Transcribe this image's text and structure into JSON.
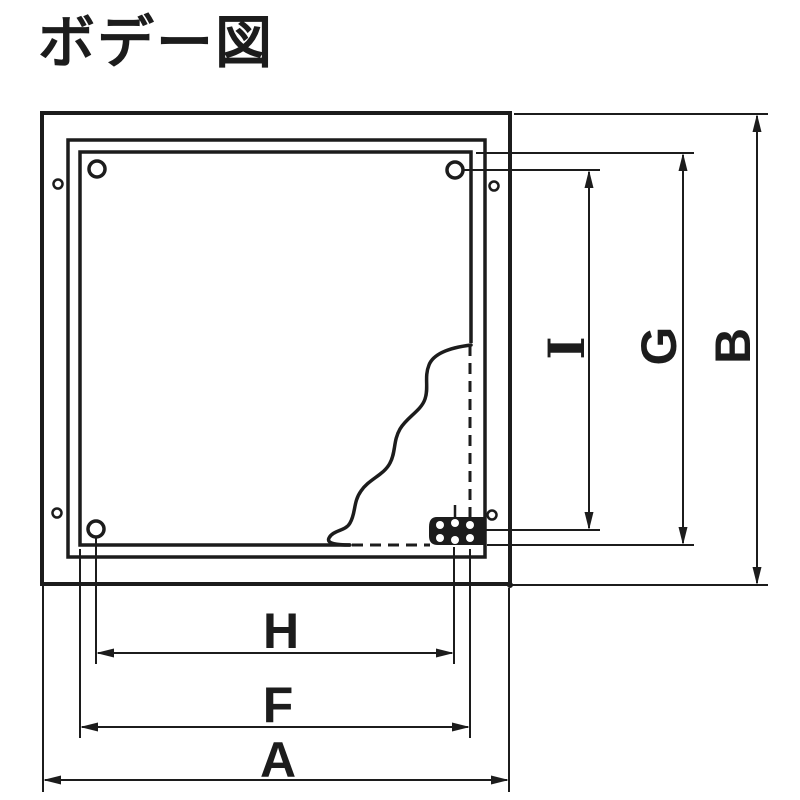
{
  "page": {
    "background_color": "#ffffff",
    "line_color": "#1c1c1c",
    "kind": "technical-drawing"
  },
  "title": "ボデー図",
  "dimensions": {
    "a": {
      "label": "A"
    },
    "b": {
      "label": "B"
    },
    "f": {
      "label": "F"
    },
    "g": {
      "label": "G"
    },
    "h": {
      "label": "H"
    },
    "i": {
      "label": "I"
    }
  }
}
